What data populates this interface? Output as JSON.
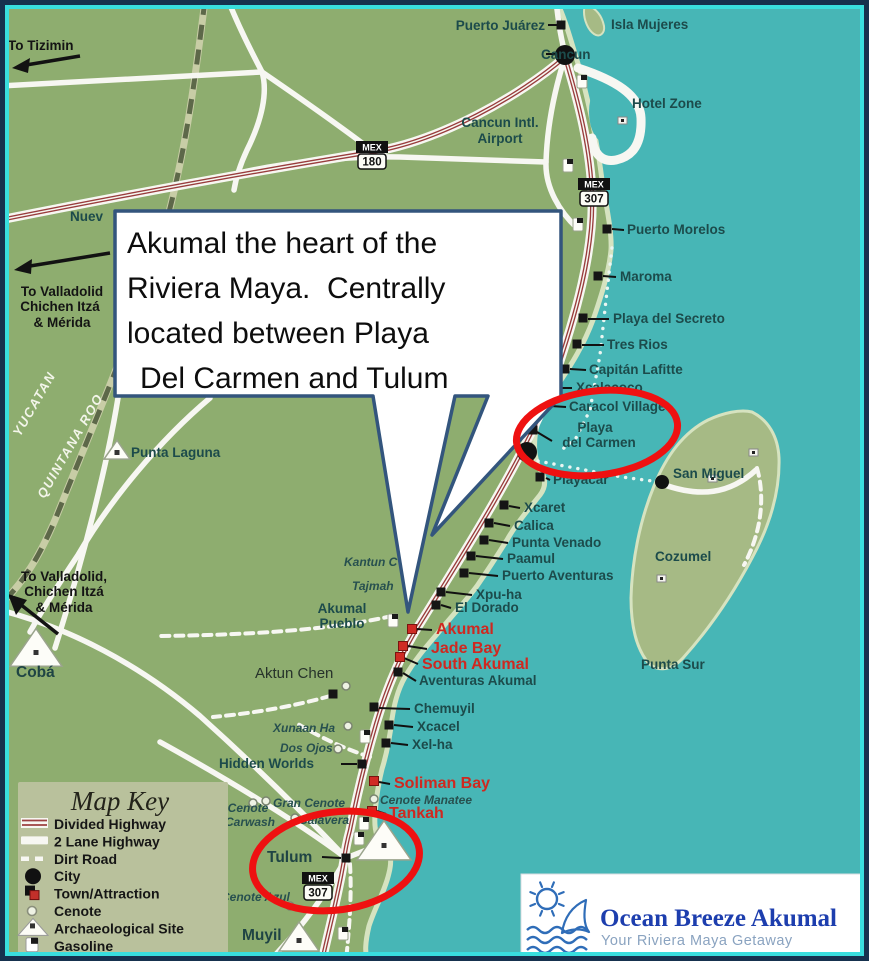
{
  "colors": {
    "ocean": "#47b6b6",
    "land": "#8ead6f",
    "island": "#a6ba85",
    "beach": "#d6e3c0",
    "road": "#f7f7f2",
    "divided_highway_red": "#993d3d",
    "dirt_border": "#5d6849",
    "place_label": "#1c4b4b",
    "red_label": "#cf2820",
    "highlight_ellipse": "#ee1111",
    "callout_border": "#33557d",
    "frame_outer": "#16314e",
    "frame_inner": "#39dede",
    "key_bg": "#b9c19c",
    "logo_title_blue": "#1d3eae",
    "logo_icon_blue": "#2f6db8",
    "logo_sub": "#8aa3c0"
  },
  "callout": {
    "lines": [
      "Akumal the heart of the",
      "Riviera Maya.  Centrally",
      "located between Playa",
      "Del Carmen and Tulum"
    ]
  },
  "map_key": {
    "title": "Map Key",
    "items": [
      {
        "icon": "divided-highway",
        "label": "Divided Highway"
      },
      {
        "icon": "two-lane-highway",
        "label": "2 Lane Highway"
      },
      {
        "icon": "dirt-road",
        "label": "Dirt Road"
      },
      {
        "icon": "city",
        "label": "City"
      },
      {
        "icon": "town-attraction",
        "label": "Town/Attraction"
      },
      {
        "icon": "cenote",
        "label": "Cenote"
      },
      {
        "icon": "archaeological-site",
        "label": "Archaeological Site"
      },
      {
        "icon": "gasoline",
        "label": "Gasoline"
      }
    ]
  },
  "logo": {
    "title": "Ocean Breeze Akumal",
    "subtitle": "Your Riviera Maya Getaway"
  },
  "map": {
    "labels": [
      {
        "t": "Puerto Juárez",
        "x": 545,
        "y": 30,
        "c": "place",
        "a": "end"
      },
      {
        "t": "Isla Mujeres",
        "x": 611,
        "y": 29,
        "c": "place"
      },
      {
        "t": "Cancun",
        "x": 541,
        "y": 59,
        "c": "place"
      },
      {
        "t": "Hotel Zone",
        "x": 632,
        "y": 108,
        "c": "place"
      },
      {
        "t": "Cancun Intl.",
        "x": 500,
        "y": 127,
        "c": "place",
        "a": "middle"
      },
      {
        "t": "Airport",
        "x": 500,
        "y": 143,
        "c": "place",
        "a": "middle"
      },
      {
        "t": "Nuev",
        "x": 70,
        "y": 221,
        "c": "place"
      },
      {
        "t": "To Tizimin",
        "x": 8,
        "y": 50,
        "c": "dir"
      },
      {
        "t": "To Valladolid",
        "x": 62,
        "y": 296,
        "c": "dir",
        "a": "middle"
      },
      {
        "t": "Chichen Itzá",
        "x": 60,
        "y": 311,
        "c": "dir",
        "a": "middle"
      },
      {
        "t": "& Mérida",
        "x": 62,
        "y": 327,
        "c": "dir",
        "a": "middle"
      },
      {
        "t": "YUCATAN",
        "x": 38,
        "y": 406,
        "c": "region",
        "a": "middle",
        "r": -60
      },
      {
        "t": "QUINTANA ROO",
        "x": 74,
        "y": 448,
        "c": "region",
        "a": "middle",
        "r": -60
      },
      {
        "t": "Punta Laguna",
        "x": 131,
        "y": 457,
        "c": "place"
      },
      {
        "t": "To Valladolid,",
        "x": 64,
        "y": 581,
        "c": "dir",
        "a": "middle"
      },
      {
        "t": "Chichen Itzá",
        "x": 64,
        "y": 596,
        "c": "dir",
        "a": "middle"
      },
      {
        "t": "& Mérida",
        "x": 64,
        "y": 612,
        "c": "dir",
        "a": "middle"
      },
      {
        "t": "Cobá",
        "x": 16,
        "y": 677,
        "c": "place-lg"
      },
      {
        "t": "Puerto Morelos",
        "x": 627,
        "y": 234,
        "c": "place"
      },
      {
        "t": "Maroma",
        "x": 620,
        "y": 281,
        "c": "place"
      },
      {
        "t": "Playa del Secreto",
        "x": 613,
        "y": 323,
        "c": "place"
      },
      {
        "t": "Tres Rios",
        "x": 607,
        "y": 349,
        "c": "place"
      },
      {
        "t": "Capitán Lafitte",
        "x": 589,
        "y": 374,
        "c": "place"
      },
      {
        "t": "Xcalacoco",
        "x": 576,
        "y": 392,
        "c": "place"
      },
      {
        "t": "Caracol Village",
        "x": 569,
        "y": 411,
        "c": "place"
      },
      {
        "t": "Playa",
        "x": 595,
        "y": 432,
        "c": "place",
        "a": "middle"
      },
      {
        "t": "del Carmen",
        "x": 599,
        "y": 447,
        "c": "place",
        "a": "middle"
      },
      {
        "t": "San Miguel",
        "x": 673,
        "y": 478,
        "c": "place"
      },
      {
        "t": "Cozumel",
        "x": 655,
        "y": 561,
        "c": "place"
      },
      {
        "t": "Punta Sur",
        "x": 641,
        "y": 669,
        "c": "place"
      },
      {
        "t": "Playacar",
        "x": 553,
        "y": 484,
        "c": "place"
      },
      {
        "t": "Xcaret",
        "x": 524,
        "y": 512,
        "c": "place"
      },
      {
        "t": "Calica",
        "x": 514,
        "y": 530,
        "c": "place"
      },
      {
        "t": "Punta Venado",
        "x": 512,
        "y": 547,
        "c": "place"
      },
      {
        "t": "Paamul",
        "x": 507,
        "y": 563,
        "c": "place"
      },
      {
        "t": "Puerto Aventuras",
        "x": 502,
        "y": 580,
        "c": "place"
      },
      {
        "t": "Xpu-ha",
        "x": 476,
        "y": 599,
        "c": "place"
      },
      {
        "t": "El Dorado",
        "x": 455,
        "y": 612,
        "c": "place"
      },
      {
        "t": "Kantun C",
        "x": 344,
        "y": 566,
        "c": "cen"
      },
      {
        "t": "Tajmah",
        "x": 352,
        "y": 590,
        "c": "cen"
      },
      {
        "t": "Akumal",
        "x": 342,
        "y": 613,
        "c": "place",
        "a": "middle"
      },
      {
        "t": "Pueblo",
        "x": 342,
        "y": 628,
        "c": "place",
        "a": "middle"
      },
      {
        "t": "Akumal",
        "x": 436,
        "y": 634,
        "c": "red"
      },
      {
        "t": "Jade Bay",
        "x": 431,
        "y": 653,
        "c": "red"
      },
      {
        "t": "South Akumal",
        "x": 422,
        "y": 669,
        "c": "red"
      },
      {
        "t": "Aventuras Akumal",
        "x": 419,
        "y": 685,
        "c": "place"
      },
      {
        "t": "Aktun Chen",
        "x": 255,
        "y": 678,
        "c": "plain"
      },
      {
        "t": "Chemuyil",
        "x": 414,
        "y": 713,
        "c": "place"
      },
      {
        "t": "Xunaan Ha",
        "x": 273,
        "y": 732,
        "c": "cen"
      },
      {
        "t": "Xcacel",
        "x": 417,
        "y": 731,
        "c": "place"
      },
      {
        "t": "Dos Ojos",
        "x": 280,
        "y": 752,
        "c": "cen"
      },
      {
        "t": "Xel-ha",
        "x": 412,
        "y": 749,
        "c": "place"
      },
      {
        "t": "Hidden Worlds",
        "x": 219,
        "y": 768,
        "c": "place"
      },
      {
        "t": "Soliman Bay",
        "x": 394,
        "y": 788,
        "c": "red"
      },
      {
        "t": "Gran Cenote",
        "x": 273,
        "y": 807,
        "c": "cen"
      },
      {
        "t": "Cenote Manatee",
        "x": 380,
        "y": 804,
        "c": "cen"
      },
      {
        "t": "Tankah",
        "x": 389,
        "y": 818,
        "c": "red"
      },
      {
        "t": "Cenote",
        "x": 248,
        "y": 812,
        "c": "cen",
        "a": "middle"
      },
      {
        "t": "Carwash",
        "x": 250,
        "y": 826,
        "c": "cen",
        "a": "middle"
      },
      {
        "t": "Calavera",
        "x": 299,
        "y": 824,
        "c": "cen"
      },
      {
        "t": "Tulum",
        "x": 267,
        "y": 862,
        "c": "place-lg"
      },
      {
        "t": "Cenote Azul",
        "x": 221,
        "y": 901,
        "c": "cen"
      },
      {
        "t": "Muyil",
        "x": 242,
        "y": 940,
        "c": "place-lg"
      }
    ],
    "markers": [
      {
        "t": "sq",
        "x": 561,
        "y": 25
      },
      {
        "t": "sq",
        "x": 607,
        "y": 229
      },
      {
        "t": "sq",
        "x": 598,
        "y": 276
      },
      {
        "t": "sq",
        "x": 583,
        "y": 318
      },
      {
        "t": "sq",
        "x": 577,
        "y": 344
      },
      {
        "t": "sq",
        "x": 565,
        "y": 369
      },
      {
        "t": "sq",
        "x": 550,
        "y": 388
      },
      {
        "t": "sq",
        "x": 545,
        "y": 406
      },
      {
        "t": "sq",
        "x": 533,
        "y": 430
      },
      {
        "t": "sq",
        "x": 540,
        "y": 477
      },
      {
        "t": "sq",
        "x": 504,
        "y": 505
      },
      {
        "t": "sq",
        "x": 489,
        "y": 523
      },
      {
        "t": "sq",
        "x": 484,
        "y": 540
      },
      {
        "t": "sq",
        "x": 471,
        "y": 556
      },
      {
        "t": "sq",
        "x": 464,
        "y": 573
      },
      {
        "t": "sq",
        "x": 441,
        "y": 592
      },
      {
        "t": "sq",
        "x": 436,
        "y": 605
      },
      {
        "t": "sq",
        "x": 398,
        "y": 672
      },
      {
        "t": "sq",
        "x": 374,
        "y": 707
      },
      {
        "t": "sq",
        "x": 389,
        "y": 725
      },
      {
        "t": "sq",
        "x": 386,
        "y": 743
      },
      {
        "t": "sq",
        "x": 362,
        "y": 764
      },
      {
        "t": "sq",
        "x": 346,
        "y": 858
      },
      {
        "t": "sq",
        "x": 333,
        "y": 694
      },
      {
        "t": "red",
        "x": 412,
        "y": 629
      },
      {
        "t": "red",
        "x": 403,
        "y": 646
      },
      {
        "t": "red",
        "x": 400,
        "y": 657
      },
      {
        "t": "red",
        "x": 374,
        "y": 781
      },
      {
        "t": "red",
        "x": 372,
        "y": 811
      },
      {
        "t": "dot",
        "x": 565,
        "y": 55,
        "s": 10
      },
      {
        "t": "dot",
        "x": 527,
        "y": 452,
        "s": 10
      },
      {
        "t": "dot",
        "x": 662,
        "y": 482,
        "s": 7
      },
      {
        "t": "cen",
        "x": 346,
        "y": 686
      },
      {
        "t": "cen",
        "x": 348,
        "y": 726
      },
      {
        "t": "cen",
        "x": 338,
        "y": 749
      },
      {
        "t": "cen",
        "x": 266,
        "y": 801
      },
      {
        "t": "cen",
        "x": 295,
        "y": 818
      },
      {
        "t": "cen",
        "x": 253,
        "y": 803
      },
      {
        "t": "cen",
        "x": 290,
        "y": 906
      },
      {
        "t": "cen",
        "x": 374,
        "y": 799
      },
      {
        "t": "pyr",
        "x": 117,
        "y": 452,
        "s": 13
      },
      {
        "t": "pyr",
        "x": 36,
        "y": 652,
        "s": 26
      },
      {
        "t": "pyr",
        "x": 384,
        "y": 845,
        "s": 27
      },
      {
        "t": "pyr",
        "x": 299,
        "y": 940,
        "s": 20
      },
      {
        "t": "gas",
        "x": 582,
        "y": 82
      },
      {
        "t": "gas",
        "x": 568,
        "y": 166
      },
      {
        "t": "gas",
        "x": 578,
        "y": 225
      },
      {
        "t": "gas",
        "x": 393,
        "y": 621
      },
      {
        "t": "gas",
        "x": 365,
        "y": 737
      },
      {
        "t": "gas",
        "x": 364,
        "y": 824
      },
      {
        "t": "gas",
        "x": 359,
        "y": 839
      },
      {
        "t": "gas",
        "x": 343,
        "y": 934
      },
      {
        "t": "bld",
        "x": 622,
        "y": 120
      },
      {
        "t": "bld",
        "x": 753,
        "y": 452
      },
      {
        "t": "bld",
        "x": 712,
        "y": 478
      },
      {
        "t": "bld",
        "x": 661,
        "y": 578
      }
    ],
    "leaders": [
      [
        548,
        25,
        557,
        25
      ],
      [
        546,
        54,
        555,
        54
      ],
      [
        612,
        229,
        624,
        230
      ],
      [
        603,
        276,
        616,
        277
      ],
      [
        588,
        319,
        609,
        319
      ],
      [
        582,
        345,
        604,
        345
      ],
      [
        570,
        369,
        586,
        370
      ],
      [
        556,
        388,
        572,
        388
      ],
      [
        551,
        406,
        566,
        407
      ],
      [
        537,
        432,
        552,
        441
      ],
      [
        546,
        478,
        550,
        480
      ],
      [
        509,
        506,
        520,
        508
      ],
      [
        494,
        523,
        510,
        526
      ],
      [
        489,
        540,
        508,
        543
      ],
      [
        476,
        556,
        503,
        559
      ],
      [
        469,
        573,
        498,
        576
      ],
      [
        446,
        592,
        472,
        595
      ],
      [
        441,
        605,
        451,
        608
      ],
      [
        417,
        629,
        432,
        630
      ],
      [
        408,
        646,
        427,
        649
      ],
      [
        404,
        658,
        418,
        664
      ],
      [
        403,
        673,
        416,
        681
      ],
      [
        379,
        708,
        410,
        709
      ],
      [
        394,
        725,
        413,
        727
      ],
      [
        391,
        743,
        408,
        745
      ],
      [
        341,
        764,
        357,
        764
      ],
      [
        379,
        782,
        390,
        784
      ],
      [
        377,
        811,
        386,
        814
      ],
      [
        322,
        857,
        341,
        858
      ]
    ],
    "shields": [
      {
        "system": "MEX",
        "number": "180",
        "x": 372,
        "y": 141
      },
      {
        "system": "MEX",
        "number": "307",
        "x": 594,
        "y": 178
      },
      {
        "system": "MEX",
        "number": "307",
        "x": 318,
        "y": 872
      }
    ],
    "highlight_ellipses": [
      {
        "cx": 597,
        "cy": 433,
        "rx": 81,
        "ry": 42,
        "rot": -7
      },
      {
        "cx": 336,
        "cy": 861,
        "rx": 84,
        "ry": 49,
        "rot": -8
      }
    ],
    "ferry_routes": [
      [
        612,
        248,
        606,
        300,
        600,
        355,
        590,
        410,
        576,
        438,
        558,
        453
      ],
      [
        538,
        461,
        580,
        469,
        622,
        477,
        652,
        481
      ]
    ]
  }
}
